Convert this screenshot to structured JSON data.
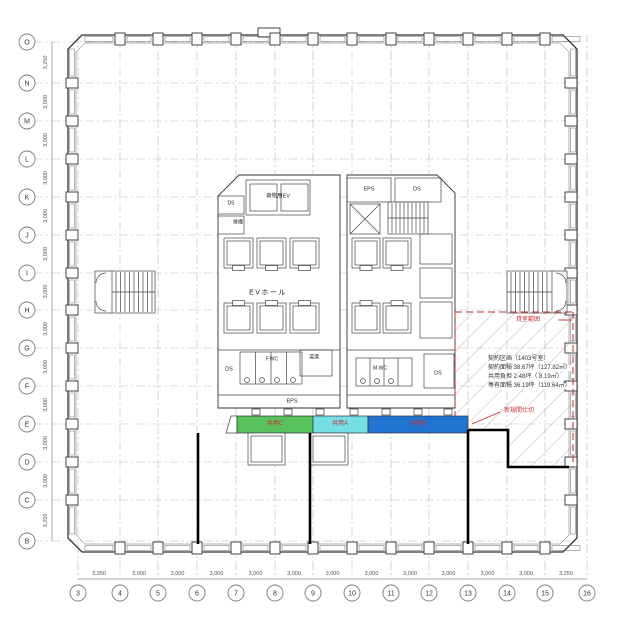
{
  "axes": {
    "rows": [
      "O",
      "N",
      "M",
      "L",
      "K",
      "J",
      "I",
      "H",
      "G",
      "F",
      "E",
      "D",
      "C",
      "B"
    ],
    "row_dims": [
      "3,250",
      "3,000",
      "3,000",
      "3,000",
      "3,000",
      "3,000",
      "3,000",
      "3,000",
      "3,000",
      "3,000",
      "3,000",
      "3,000",
      "3,250"
    ],
    "cols": [
      "3",
      "4",
      "5",
      "6",
      "7",
      "8",
      "9",
      "10",
      "11",
      "12",
      "13",
      "14",
      "15",
      "16"
    ],
    "col_dims": [
      "3,250",
      "3,000",
      "3,000",
      "3,000",
      "3,000",
      "3,000",
      "3,000",
      "3,000",
      "3,000",
      "3,000",
      "3,000",
      "3,000",
      "3,250"
    ]
  },
  "core": {
    "cargo_ev": "荷物用EV",
    "eps_top": "EPS",
    "ds_top_right": "DS",
    "ds_top_left": "DS",
    "smoke_vent": "排煙",
    "ev_hall": "EVホール",
    "ds_mid_left": "DS",
    "fwc": "F.WC",
    "hot_water": "湯沸",
    "mwc": "M.WC",
    "ds_mid_right": "DS",
    "eps_bottom": "EPS"
  },
  "zones": [
    {
      "id": "kyoyo-c",
      "label": "共用C",
      "color": "#58c25c"
    },
    {
      "id": "kyoyo-a",
      "label": "共用A",
      "color": "#74dfe4"
    },
    {
      "id": "kyoyo-b",
      "label": "共用B",
      "color": "#2173d2"
    }
  ],
  "lease": {
    "boundary_label": "貸室範囲",
    "partition_label": "新規間仕切",
    "info_lines": [
      "契約区画（1403号室）",
      "契約面積 38.67坪（127.82㎡）",
      "共用負担  2.48坪（ 8.19㎡）",
      "専有面積 36.19坪（119.64㎡）"
    ],
    "accent_color": "#c22f2f",
    "zone_label_color": "#d03030"
  }
}
